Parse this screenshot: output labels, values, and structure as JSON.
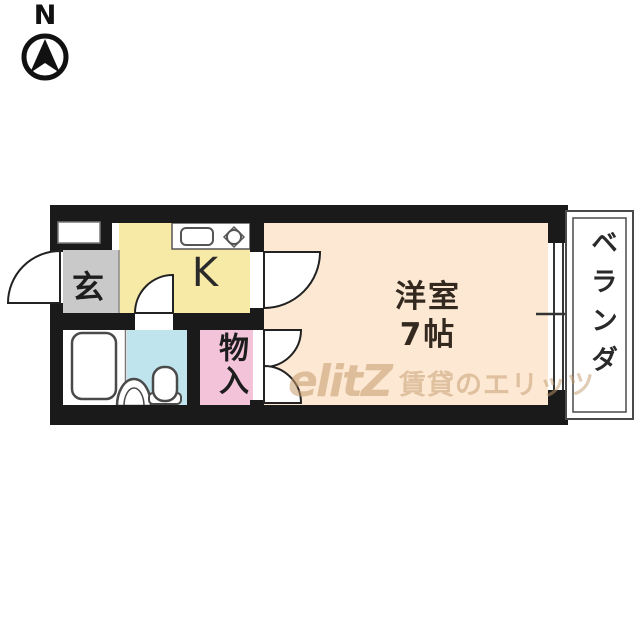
{
  "compass": {
    "label": "N"
  },
  "rooms": {
    "genkan": {
      "label": "玄"
    },
    "kitchen": {
      "label": "K"
    },
    "western": {
      "label": "洋室",
      "size": "7帖"
    },
    "storage": {
      "label": "物入"
    },
    "veranda": {
      "label": "ベランダ"
    }
  },
  "fixtures": [
    "bathtub",
    "toilet",
    "wash-basin",
    "kitchen-sink",
    "stove-burner"
  ],
  "watermark": {
    "logo": "elitZ",
    "text": "賃貸のエリッツ"
  },
  "colors": {
    "wall": "#1a1a1a",
    "genkan": "#c9c9c9",
    "kitchen": "#f7e9a6",
    "western": "#fce8d3",
    "storage": "#f3c3d9",
    "toilet": "#bfe4ee",
    "fixture_stroke": "#4a4a4a",
    "watermark": "#c49a6c"
  }
}
